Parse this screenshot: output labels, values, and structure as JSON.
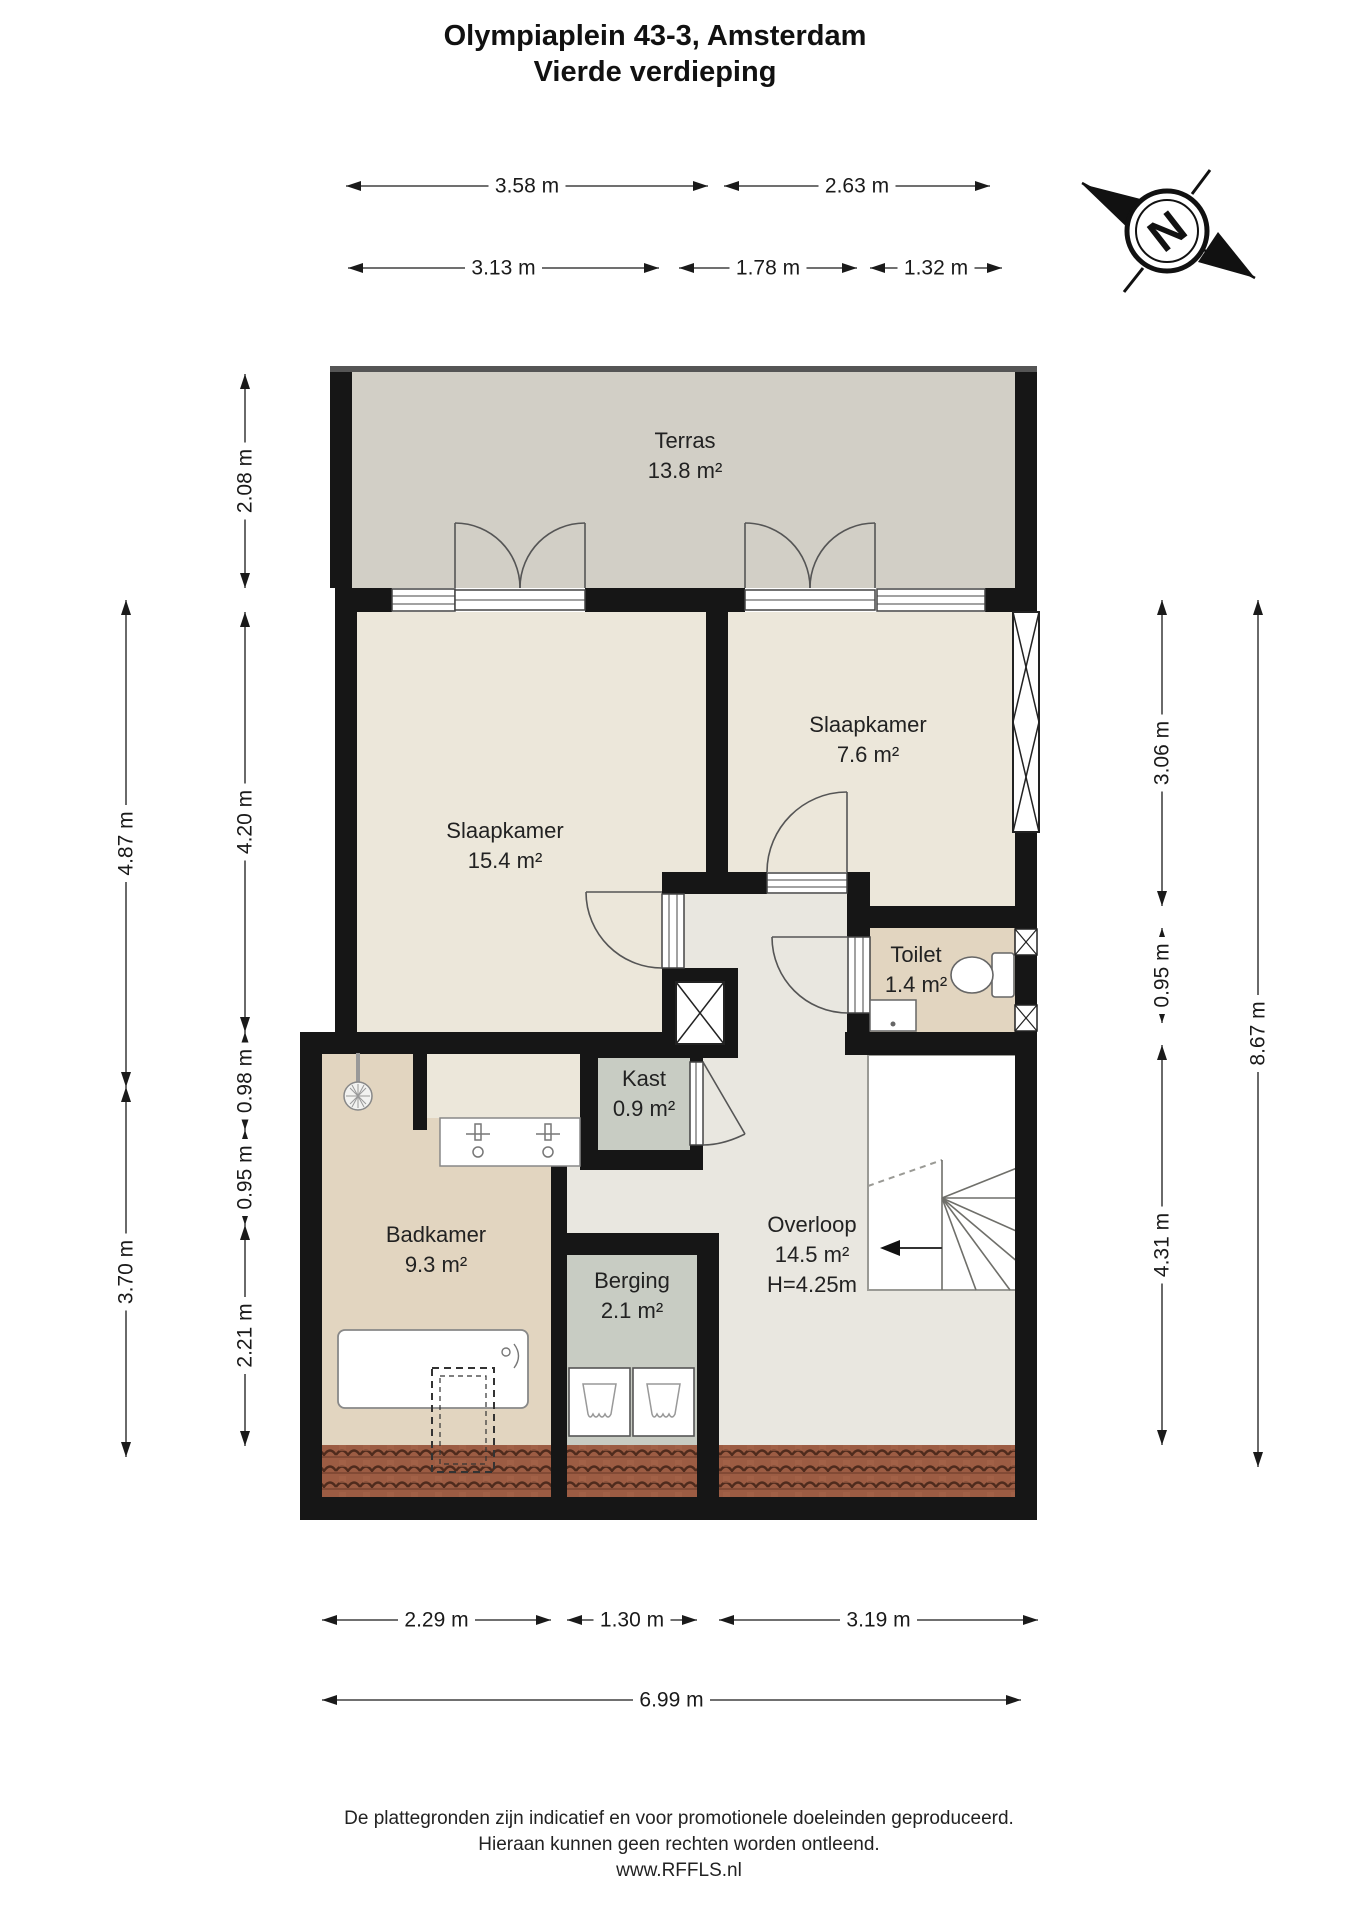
{
  "title": {
    "line1": "Olympiaplein 43-3, Amsterdam",
    "line2": "Vierde verdieping"
  },
  "compass": {
    "letter": "N"
  },
  "rooms": [
    {
      "id": "terras",
      "name": "Terras",
      "area": "13.8 m²",
      "cx": 685,
      "cy": 448
    },
    {
      "id": "slaapkamer-1",
      "name": "Slaapkamer",
      "area": "15.4 m²",
      "cx": 505,
      "cy": 838
    },
    {
      "id": "slaapkamer-2",
      "name": "Slaapkamer",
      "area": "7.6 m²",
      "cx": 868,
      "cy": 732
    },
    {
      "id": "toilet",
      "name": "Toilet",
      "area": "1.4 m²",
      "cx": 916,
      "cy": 962
    },
    {
      "id": "kast",
      "name": "Kast",
      "area": "0.9 m²",
      "cx": 644,
      "cy": 1086
    },
    {
      "id": "badkamer",
      "name": "Badkamer",
      "area": "9.3 m²",
      "cx": 436,
      "cy": 1242
    },
    {
      "id": "berging",
      "name": "Berging",
      "area": "2.1 m²",
      "cx": 632,
      "cy": 1288
    },
    {
      "id": "overloop",
      "name": "Overloop",
      "area": "14.5 m²",
      "extra": "H=4.25m",
      "cx": 812,
      "cy": 1232
    }
  ],
  "dimensions": {
    "horizontal": [
      {
        "label": "3.58 m",
        "x1": 346,
        "x2": 708,
        "y": 186
      },
      {
        "label": "2.63 m",
        "x1": 724,
        "x2": 990,
        "y": 186
      },
      {
        "label": "3.13 m",
        "x1": 348,
        "x2": 659,
        "y": 268
      },
      {
        "label": "1.78 m",
        "x1": 679,
        "x2": 857,
        "y": 268
      },
      {
        "label": "1.32 m",
        "x1": 870,
        "x2": 1002,
        "y": 268
      },
      {
        "label": "2.29 m",
        "x1": 322,
        "x2": 551,
        "y": 1620
      },
      {
        "label": "1.30 m",
        "x1": 567,
        "x2": 697,
        "y": 1620
      },
      {
        "label": "3.19 m",
        "x1": 719,
        "x2": 1038,
        "y": 1620
      },
      {
        "label": "6.99 m",
        "x1": 322,
        "x2": 1021,
        "y": 1700
      }
    ],
    "vertical": [
      {
        "label": "2.08 m",
        "x": 245,
        "y1": 374,
        "y2": 588
      },
      {
        "label": "4.20 m",
        "x": 245,
        "y1": 612,
        "y2": 1032
      },
      {
        "label": "0.98 m",
        "x": 245,
        "y1": 1032,
        "y2": 1130
      },
      {
        "label": "0.95 m",
        "x": 245,
        "y1": 1130,
        "y2": 1225
      },
      {
        "label": "2.21 m",
        "x": 245,
        "y1": 1225,
        "y2": 1446
      },
      {
        "label": "4.87 m",
        "x": 126,
        "y1": 600,
        "y2": 1087
      },
      {
        "label": "3.70 m",
        "x": 126,
        "y1": 1087,
        "y2": 1457
      },
      {
        "label": "3.06 m",
        "x": 1162,
        "y1": 600,
        "y2": 906
      },
      {
        "label": "0.95 m",
        "x": 1162,
        "y1": 928,
        "y2": 1023
      },
      {
        "label": "4.31 m",
        "x": 1162,
        "y1": 1045,
        "y2": 1445
      },
      {
        "label": "8.67 m",
        "x": 1258,
        "y1": 600,
        "y2": 1467
      }
    ]
  },
  "footer": {
    "line1": "De plattegronden zijn indicatief en voor promotionele doeleinden geproduceerd.",
    "line2": "Hieraan kunnen geen rechten worden ontleend.",
    "line3": "www.RFFLS.nl"
  },
  "colors": {
    "wall": "#161616",
    "terras": "#d2cfc6",
    "bedroom": "#ece7da",
    "wet_room": "#e2d5c0",
    "cabinet": "#c8ccc3",
    "hallway": "#e9e7e0",
    "roof_tile": "#9c5c43",
    "text": "#1a1a1a"
  }
}
